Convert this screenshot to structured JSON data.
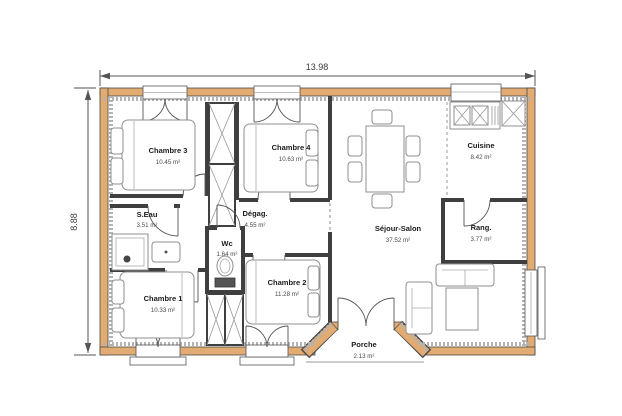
{
  "plan": {
    "title": "house-floor-plan",
    "dimensions": {
      "width_label": "13.98",
      "height_label": "8.88"
    },
    "colors": {
      "wall": "#E2AB72",
      "insulation": "#b3b3b3",
      "interior_wall": "#3f3f3f",
      "background": "#ffffff"
    },
    "rooms": {
      "chambre3": {
        "name": "Chambre 3",
        "area": "10.45 m²"
      },
      "chambre4": {
        "name": "Chambre 4",
        "area": "10.63 m²"
      },
      "cuisine": {
        "name": "Cuisine",
        "area": "8.42 m²"
      },
      "seau": {
        "name": "S.Eau",
        "area": "3.51 m²"
      },
      "degag": {
        "name": "Dégag.",
        "area": "4.55 m²"
      },
      "wc": {
        "name": "Wc",
        "area": "1.64 m²"
      },
      "sejour": {
        "name": "Séjour-Salon",
        "area": "37.52 m²"
      },
      "rang": {
        "name": "Rang.",
        "area": "3.77 m²"
      },
      "chambre1": {
        "name": "Chambre 1",
        "area": "10.33 m²"
      },
      "chambre2": {
        "name": "Chambre 2",
        "area": "11.28 m²"
      },
      "porche": {
        "name": "Porche",
        "area": "2.13 m²"
      }
    }
  }
}
